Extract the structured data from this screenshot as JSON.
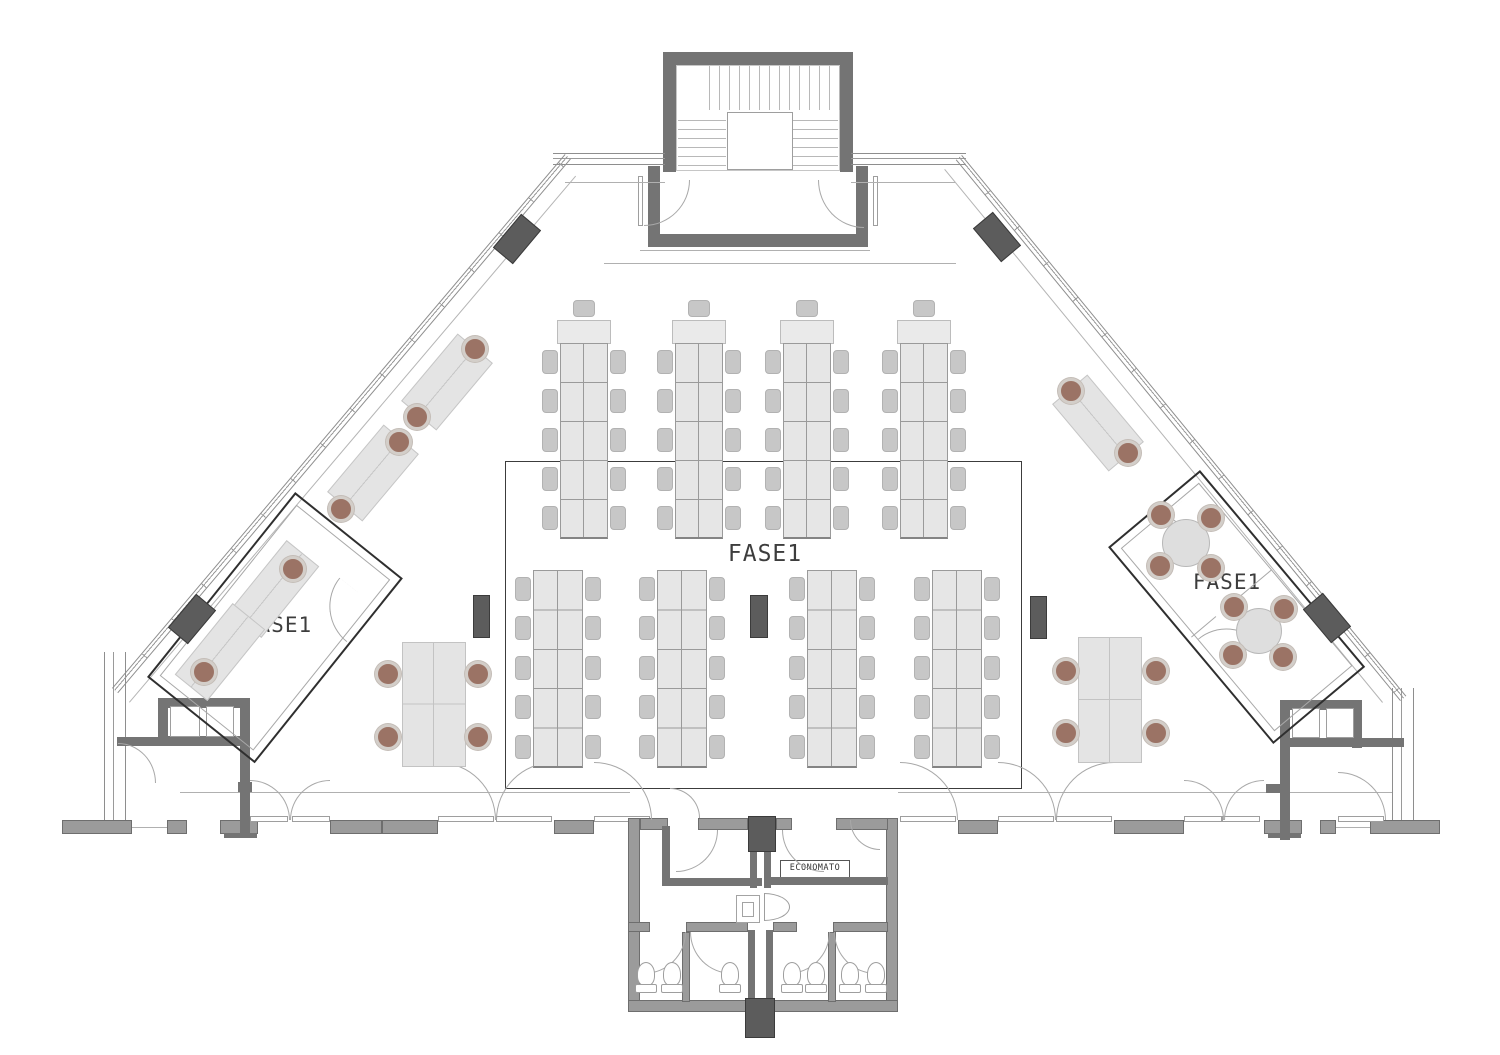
{
  "labels": {
    "zone_center": "FASE1",
    "zone_left": "FASE1",
    "zone_right": "FASE1",
    "storage_room": "ECONOMATO"
  },
  "colors": {
    "wall_dark": "#747474",
    "wall_mid": "#9b9b9b",
    "column": "#5c5c5c",
    "desk_fill": "#e6e6e6",
    "chair_gray": "#c7c7c7",
    "chair_brown": "#9b7365",
    "line_thin": "#b0b0b0",
    "room_border": "#2f2f2f"
  },
  "plan": {
    "rects": [
      [
        663,
        52,
        190,
        13,
        "dark",
        "stair-wall"
      ],
      [
        663,
        52,
        13,
        120,
        "dark",
        "stair-wall"
      ],
      [
        840,
        52,
        13,
        120,
        "dark",
        "stair-wall"
      ],
      [
        676,
        65,
        164,
        106,
        "outline",
        "stair-inner-outline"
      ],
      [
        700,
        66,
        140,
        44,
        "trv",
        "stair-flight-up"
      ],
      [
        678,
        112,
        48,
        60,
        "trh",
        "stair-flight-left"
      ],
      [
        790,
        112,
        48,
        60,
        "trh",
        "stair-flight-right"
      ],
      [
        727,
        112,
        66,
        58,
        "white",
        "stair-landing"
      ],
      [
        648,
        166,
        12,
        76,
        "dark",
        "vestibule-wall"
      ],
      [
        856,
        166,
        12,
        76,
        "dark",
        "vestibule-wall"
      ],
      [
        648,
        234,
        220,
        13,
        "dark",
        "vestibule-wall"
      ],
      [
        638,
        176,
        5,
        50,
        "white",
        "door-leaf"
      ],
      [
        873,
        176,
        5,
        50,
        "white",
        "door-leaf"
      ],
      [
        553,
        153,
        112,
        12,
        "winh",
        "top-window-wall"
      ],
      [
        851,
        153,
        115,
        12,
        "winh",
        "top-window-wall"
      ],
      [
        565,
        182,
        100,
        1,
        "thin",
        "sill-line"
      ],
      [
        851,
        182,
        104,
        1,
        "thin",
        "sill-line"
      ],
      [
        640,
        250,
        230,
        1,
        "thin",
        "step-line"
      ],
      [
        604,
        263,
        352,
        1,
        "thin",
        "step-line"
      ],
      [
        104,
        652,
        22,
        170,
        "winv",
        "left-wall-lower"
      ],
      [
        1392,
        688,
        22,
        134,
        "winv",
        "right-wall-lower"
      ],
      [
        62,
        820,
        70,
        14,
        "mid",
        "bottom-wall"
      ],
      [
        132,
        827,
        36,
        1,
        "thin",
        "threshold"
      ],
      [
        167,
        820,
        20,
        14,
        "mid",
        "bottom-wall"
      ],
      [
        220,
        820,
        38,
        14,
        "mid",
        "bottom-wall"
      ],
      [
        224,
        833,
        33,
        5,
        "dark",
        "bottom-wall-dark"
      ],
      [
        330,
        820,
        52,
        14,
        "mid",
        "bottom-wall"
      ],
      [
        382,
        820,
        56,
        14,
        "mid",
        "bottom-wall"
      ],
      [
        554,
        820,
        40,
        14,
        "mid",
        "bottom-wall"
      ],
      [
        958,
        820,
        40,
        14,
        "mid",
        "bottom-wall"
      ],
      [
        1114,
        820,
        70,
        14,
        "mid",
        "bottom-wall"
      ],
      [
        1264,
        820,
        38,
        14,
        "mid",
        "bottom-wall"
      ],
      [
        1268,
        833,
        33,
        5,
        "dark",
        "bottom-wall-dark"
      ],
      [
        1320,
        820,
        16,
        14,
        "mid",
        "bottom-wall"
      ],
      [
        1336,
        827,
        34,
        1,
        "thin",
        "threshold"
      ],
      [
        1370,
        820,
        70,
        14,
        "mid",
        "bottom-wall"
      ],
      [
        250,
        816,
        38,
        6,
        "white",
        "door-leaf"
      ],
      [
        292,
        816,
        38,
        6,
        "white",
        "door-leaf"
      ],
      [
        438,
        816,
        56,
        6,
        "white",
        "door-leaf"
      ],
      [
        496,
        816,
        56,
        6,
        "white",
        "door-leaf"
      ],
      [
        594,
        816,
        56,
        6,
        "white",
        "door-leaf"
      ],
      [
        900,
        816,
        56,
        6,
        "white",
        "door-leaf"
      ],
      [
        998,
        816,
        56,
        6,
        "white",
        "door-leaf"
      ],
      [
        1056,
        816,
        56,
        6,
        "white",
        "door-leaf"
      ],
      [
        1184,
        816,
        38,
        6,
        "white",
        "door-leaf"
      ],
      [
        1222,
        816,
        38,
        6,
        "white",
        "door-leaf"
      ],
      [
        1338,
        816,
        46,
        6,
        "white",
        "door-leaf"
      ],
      [
        180,
        792,
        450,
        1,
        "thin",
        "corridor-line"
      ],
      [
        898,
        792,
        494,
        1,
        "thin",
        "corridor-line"
      ],
      [
        158,
        698,
        92,
        10,
        "dark",
        "shaft-wall"
      ],
      [
        158,
        698,
        10,
        48,
        "dark",
        "shaft-wall"
      ],
      [
        240,
        698,
        10,
        140,
        "dark",
        "shaft-wall"
      ],
      [
        158,
        736,
        92,
        10,
        "dark",
        "shaft-wall"
      ],
      [
        117,
        737,
        42,
        9,
        "dark",
        "shaft-wall"
      ],
      [
        170,
        706,
        30,
        31,
        "white",
        "shaft-cell"
      ],
      [
        206,
        706,
        28,
        31,
        "white",
        "shaft-cell"
      ],
      [
        238,
        782,
        14,
        10,
        "dark",
        "wall-stub"
      ],
      [
        1280,
        700,
        82,
        10,
        "dark",
        "shaft-wall"
      ],
      [
        1280,
        700,
        10,
        140,
        "dark",
        "shaft-wall"
      ],
      [
        1352,
        700,
        10,
        48,
        "dark",
        "shaft-wall"
      ],
      [
        1280,
        738,
        124,
        9,
        "dark",
        "shaft-wall"
      ],
      [
        1292,
        708,
        28,
        30,
        "white",
        "shaft-cell"
      ],
      [
        1326,
        708,
        28,
        30,
        "white",
        "shaft-cell"
      ],
      [
        1266,
        784,
        16,
        9,
        "dark",
        "wall-stub"
      ],
      [
        505,
        461,
        517,
        328,
        "outline2",
        "open-space-boundary"
      ],
      [
        628,
        818,
        12,
        194,
        "mid",
        "service-wall"
      ],
      [
        886,
        818,
        12,
        194,
        "mid",
        "service-wall"
      ],
      [
        628,
        1000,
        270,
        12,
        "mid",
        "service-wall"
      ],
      [
        640,
        818,
        28,
        12,
        "mid",
        "service-wall"
      ],
      [
        698,
        818,
        50,
        12,
        "mid",
        "service-wall"
      ],
      [
        776,
        818,
        16,
        12,
        "mid",
        "service-wall"
      ],
      [
        836,
        818,
        52,
        12,
        "mid",
        "service-wall"
      ],
      [
        662,
        826,
        8,
        56,
        "dark",
        "vestibule-room-wall"
      ],
      [
        662,
        878,
        100,
        8,
        "dark",
        "vestibule-room-wall"
      ],
      [
        750,
        852,
        7,
        36,
        "dark",
        "duct-wall"
      ],
      [
        764,
        852,
        7,
        36,
        "dark",
        "duct-wall"
      ],
      [
        768,
        877,
        120,
        8,
        "dark",
        "economato-wall"
      ],
      [
        748,
        930,
        7,
        72,
        "dark",
        "duct-wall"
      ],
      [
        766,
        930,
        7,
        72,
        "dark",
        "duct-wall"
      ],
      [
        628,
        922,
        22,
        10,
        "mid",
        "wc-wall"
      ],
      [
        686,
        922,
        62,
        10,
        "mid",
        "wc-wall"
      ],
      [
        773,
        922,
        24,
        10,
        "mid",
        "wc-wall"
      ],
      [
        833,
        922,
        55,
        10,
        "mid",
        "wc-wall"
      ],
      [
        682,
        932,
        8,
        70,
        "mid",
        "stall-divider"
      ],
      [
        828,
        932,
        8,
        70,
        "mid",
        "stall-divider"
      ],
      [
        736,
        895,
        24,
        28,
        "fix",
        "wc-fixture"
      ],
      [
        742,
        902,
        12,
        15,
        "fix",
        "wc-fixture-inner"
      ],
      [
        764,
        893,
        26,
        28,
        "sink",
        "wc-sink"
      ],
      [
        748,
        816,
        28,
        36,
        "col",
        "column"
      ],
      [
        745,
        998,
        30,
        40,
        "col",
        "column"
      ],
      [
        473,
        595,
        17,
        43,
        "col",
        "column"
      ],
      [
        750,
        595,
        18,
        43,
        "col",
        "column"
      ],
      [
        1030,
        596,
        17,
        43,
        "col",
        "column"
      ]
    ],
    "windows": [
      [
        112,
        688,
        700,
        8,
        -49.7,
        "strip",
        "window-wall-left"
      ],
      [
        129,
        702,
        690,
        1,
        -49.7,
        "sill",
        "sill-line-left"
      ],
      [
        962,
        155,
        700,
        8,
        50.6,
        "strip",
        "window-wall-right"
      ],
      [
        945,
        169,
        690,
        1,
        50.6,
        "sill",
        "sill-line-right"
      ]
    ],
    "arcs": [
      [
        644,
        180,
        46,
        46,
        "br"
      ],
      [
        818,
        180,
        46,
        48,
        "bl"
      ],
      [
        250,
        780,
        40,
        40,
        "tr"
      ],
      [
        290,
        780,
        40,
        40,
        "tl"
      ],
      [
        438,
        762,
        58,
        58,
        "tr"
      ],
      [
        496,
        762,
        58,
        58,
        "tl"
      ],
      [
        594,
        762,
        58,
        58,
        "tr"
      ],
      [
        900,
        762,
        58,
        58,
        "tr"
      ],
      [
        998,
        762,
        58,
        58,
        "tr"
      ],
      [
        1056,
        762,
        58,
        58,
        "tl"
      ],
      [
        1184,
        780,
        40,
        40,
        "tr"
      ],
      [
        1224,
        780,
        40,
        40,
        "tl"
      ],
      [
        1338,
        772,
        48,
        48,
        "tr"
      ],
      [
        118,
        743,
        38,
        40,
        "tr"
      ],
      [
        670,
        788,
        30,
        30,
        "tr"
      ],
      [
        850,
        820,
        30,
        30,
        "bl"
      ],
      [
        676,
        830,
        42,
        42,
        "br"
      ],
      [
        782,
        830,
        42,
        42,
        "bl"
      ],
      [
        644,
        932,
        42,
        42,
        "br"
      ],
      [
        690,
        932,
        42,
        42,
        "bl"
      ],
      [
        788,
        932,
        42,
        42,
        "br"
      ],
      [
        834,
        932,
        42,
        42,
        "bl"
      ]
    ],
    "rooms": [
      {
        "name": "office-room-left",
        "x": 147,
        "y": 677,
        "w": 237,
        "h": 138,
        "rot": -51.3,
        "parts": [],
        "arcs": [
          [
            150,
            86,
            46,
            46,
            "tl"
          ]
        ]
      },
      {
        "name": "meeting-room-right",
        "x": 1200,
        "y": 470,
        "w": 257,
        "h": 120,
        "rot": 50,
        "parts": [
          [
            120,
            8,
            1,
            42
          ],
          [
            120,
            80,
            1,
            32
          ]
        ],
        "arcs": [
          [
            10,
            12,
            40,
            40,
            "br"
          ],
          [
            126,
            64,
            44,
            44,
            "tl"
          ]
        ]
      }
    ],
    "columns_rot": [
      [
        517,
        239,
        44,
        26,
        130
      ],
      [
        997,
        237,
        44,
        26,
        50
      ],
      [
        192,
        619,
        44,
        26,
        130
      ],
      [
        1327,
        618,
        44,
        26,
        50
      ]
    ],
    "upper_banks": {
      "xs": [
        560,
        675,
        783,
        900
      ],
      "y": 343,
      "rows": 5,
      "rowH": 39,
      "w": 48,
      "cab": true
    },
    "lower_banks": {
      "xs": [
        533,
        657,
        807,
        932
      ],
      "y": 570,
      "rows": 5,
      "rowH": 39.4,
      "w": 50,
      "cab": false
    },
    "desks": [
      [
        447,
        382,
        88,
        46,
        -50
      ],
      [
        373,
        473,
        88,
        46,
        -50
      ],
      [
        1098,
        423,
        88,
        46,
        50
      ],
      [
        274,
        589,
        92,
        42,
        -51
      ],
      [
        220,
        652,
        92,
        42,
        -51
      ]
    ],
    "tables": [
      [
        402,
        642,
        64,
        125
      ],
      [
        1078,
        637,
        64,
        126
      ]
    ],
    "round_tables": [
      [
        1186,
        543,
        48
      ],
      [
        1259,
        631,
        46
      ]
    ],
    "toilets": [
      646,
      672,
      730,
      792,
      816,
      850,
      876
    ],
    "brown_chairs": [
      [
        475,
        349
      ],
      [
        417,
        417
      ],
      [
        399,
        442
      ],
      [
        341,
        509
      ],
      [
        1071,
        391
      ],
      [
        1128,
        453
      ],
      [
        293,
        569
      ],
      [
        204,
        672
      ],
      [
        388,
        674
      ],
      [
        388,
        737
      ],
      [
        478,
        674
      ],
      [
        478,
        737
      ],
      [
        1066,
        671
      ],
      [
        1066,
        733
      ],
      [
        1156,
        671
      ],
      [
        1156,
        733
      ],
      [
        1161,
        515
      ],
      [
        1211,
        518
      ],
      [
        1160,
        566
      ],
      [
        1211,
        568
      ],
      [
        1234,
        607
      ],
      [
        1284,
        609
      ],
      [
        1233,
        655
      ],
      [
        1283,
        657
      ]
    ]
  }
}
